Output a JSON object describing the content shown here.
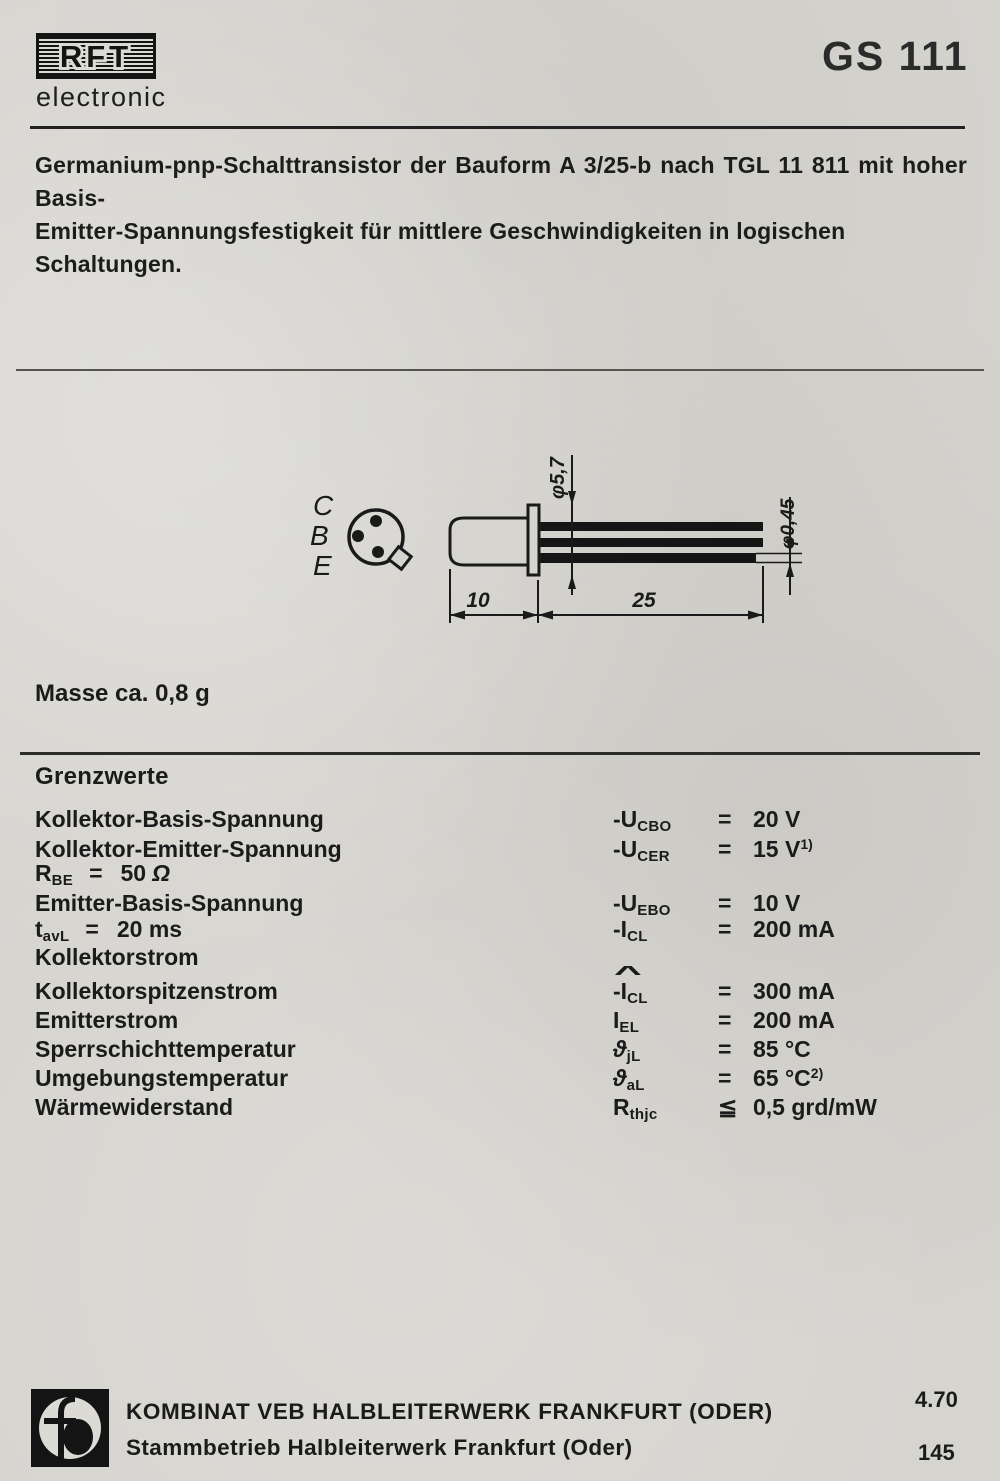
{
  "page": {
    "paper_color": "#d6d4cf",
    "ink_color": "#1b1b1b"
  },
  "header": {
    "brand": "RFT",
    "brand_sub": "electronic",
    "part_number": "GS 111"
  },
  "description": {
    "line1": "Germanium-pnp-Schalttransistor der Bauform A 3/25-b nach TGL 11 811 mit hoher Basis-",
    "line2": "Emitter-Spannungsfestigkeit für mittlere Geschwindigkeiten in logischen Schaltungen."
  },
  "drawing": {
    "pin_labels": [
      "C",
      "B",
      "E"
    ],
    "dim_flange_diameter": "φ5,7",
    "dim_lead_diameter": "φ0,45",
    "dim_body_length": "10",
    "dim_lead_length": "25"
  },
  "mass_note": "Masse ca. 0,8 g",
  "limits": {
    "title": "Grenzwerte",
    "rows": [
      {
        "label": "Kollektor-Basis-Spannung",
        "sym": "-U",
        "sub": "CBO",
        "rel": "=",
        "val": "20 V",
        "sup": ""
      },
      {
        "label": "Kollektor-Emitter-Spannung",
        "sym": "-U",
        "sub": "CER",
        "rel": "=",
        "val": "15 V",
        "sup": "1)"
      },
      {
        "cond_sym": "R",
        "cond_sub": "BE",
        "cond_eq": "=",
        "cond_val": "50",
        "cond_unit": "Ω"
      },
      {
        "label": "Emitter-Basis-Spannung",
        "sym": "-U",
        "sub": "EBO",
        "rel": "=",
        "val": "10 V",
        "sup": ""
      },
      {
        "cond_sym": "t",
        "cond_sub": "avL",
        "cond_eq": "=",
        "cond_val": "20 ms",
        "sym": "-I",
        "sub": "CL",
        "rel": "=",
        "val": "200 mA",
        "sup": ""
      },
      {
        "label": "Kollektorstrom"
      },
      {
        "label": "Kollektorspitzenstrom",
        "hat": "^",
        "sym": "-I",
        "sub": "CL",
        "rel": "=",
        "val": "300 mA",
        "sup": ""
      },
      {
        "label": "Emitterstrom",
        "sym": "I",
        "sub": "EL",
        "rel": "=",
        "val": "200 mA",
        "sup": ""
      },
      {
        "label": "Sperrschichttemperatur",
        "sym": "ϑ",
        "sub": "jL",
        "rel": "=",
        "val": "85 °C",
        "sup": ""
      },
      {
        "label": "Umgebungstemperatur",
        "sym": "ϑ",
        "sub": "aL",
        "rel": "=",
        "val": "65 °C",
        "sup": "2)"
      },
      {
        "label": "Wärmewiderstand",
        "sym": "R",
        "sub": "thjc",
        "rel": "≦",
        "val": "0,5 grd/mW",
        "sup": ""
      }
    ]
  },
  "footer": {
    "company_line1": "KOMBINAT VEB HALBLEITERWERK FRANKFURT (ODER)",
    "company_line2": "Stammbetrieb Halbleiterwerk Frankfurt (Oder)",
    "date_code": "4.70",
    "page_number": "145"
  }
}
